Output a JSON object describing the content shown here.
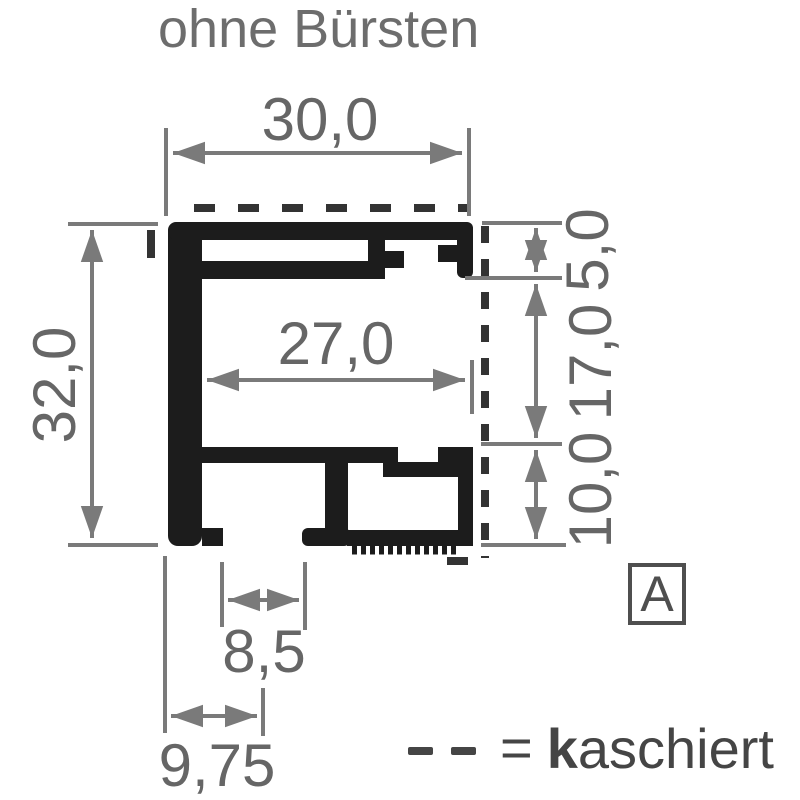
{
  "title": "ohne Bürsten",
  "drawing": {
    "dimensions": {
      "outer_width": "30,0",
      "outer_height": "32,0",
      "inner_width": "27,0",
      "top_depth": "5,0",
      "channel_height": "17,0",
      "bottom_depth": "10,0",
      "slot_width": "8,5",
      "foot_offset": "9,75"
    },
    "section_marker": "A",
    "legend": {
      "equals_sign": "=",
      "term_bold_prefix": "k",
      "term_rest": "aschiert"
    },
    "colors": {
      "profile_fill": "#1c1c1c",
      "dashed_kaschiert": "#333333",
      "dimension_gray": "#7a7a7a",
      "label_gray": "#666666",
      "legend_gray": "#454545"
    }
  }
}
